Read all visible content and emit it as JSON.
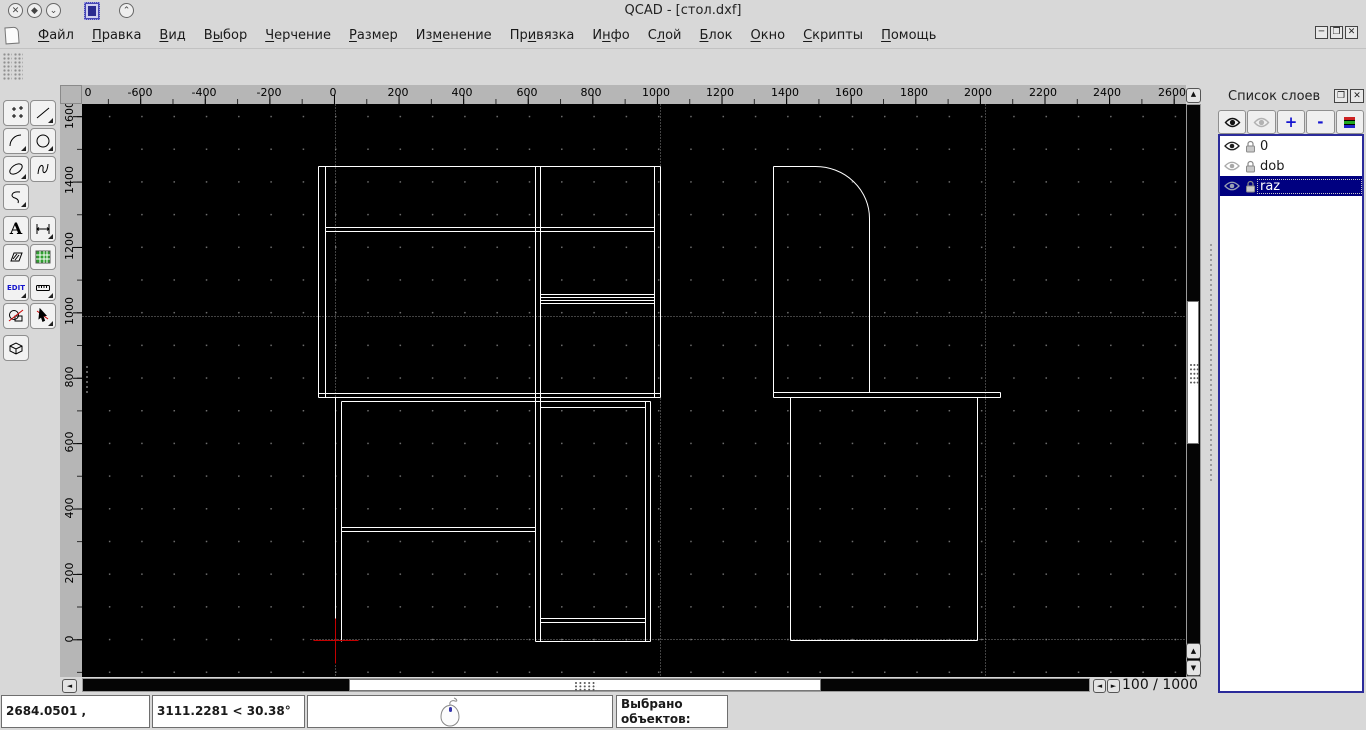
{
  "window": {
    "title": "QCAD - [стол.dxf]"
  },
  "titlebar": {
    "icons": [
      "close-circle-icon",
      "restore-circle-icon",
      "shade-circle-icon",
      "app-icon",
      "raise-circle-icon"
    ]
  },
  "menu": {
    "items": [
      {
        "label": "Файл",
        "accel": 0
      },
      {
        "label": "Правка",
        "accel": 0
      },
      {
        "label": "Вид",
        "accel": 0
      },
      {
        "label": "Выбор",
        "accel": 1
      },
      {
        "label": "Черчение",
        "accel": 0
      },
      {
        "label": "Размер",
        "accel": 0
      },
      {
        "label": "Изменение",
        "accel": 2
      },
      {
        "label": "Привязка",
        "accel": 2
      },
      {
        "label": "Инфо",
        "accel": 1
      },
      {
        "label": "Слой",
        "accel": 1
      },
      {
        "label": "Блок",
        "accel": 0
      },
      {
        "label": "Окно",
        "accel": 0
      },
      {
        "label": "Скрипты",
        "accel": 0
      },
      {
        "label": "Помощь",
        "accel": 0
      }
    ],
    "window_controls": [
      "minimize",
      "restore",
      "close"
    ]
  },
  "toolbar": {
    "tools": [
      "points",
      "line",
      "arc",
      "circle",
      "ellipse",
      "spline",
      "polyline",
      "text",
      "dimension",
      "hatch",
      "image",
      "edit",
      "measure",
      "explode",
      "select",
      "cube3d"
    ],
    "text_tool_label": "A",
    "edit_tool_label": "EDIT"
  },
  "rulers": {
    "horizontal": {
      "labels": [
        {
          "t": "0",
          "x": 6
        },
        {
          "t": "-600",
          "x": 58
        },
        {
          "t": "-400",
          "x": 122
        },
        {
          "t": "-200",
          "x": 187
        },
        {
          "t": "0",
          "x": 251
        },
        {
          "t": "200",
          "x": 316
        },
        {
          "t": "400",
          "x": 380
        },
        {
          "t": "600",
          "x": 445
        },
        {
          "t": "800",
          "x": 509
        },
        {
          "t": "1000",
          "x": 574
        },
        {
          "t": "1200",
          "x": 638
        },
        {
          "t": "1400",
          "x": 703
        },
        {
          "t": "1600",
          "x": 767
        },
        {
          "t": "1800",
          "x": 832
        },
        {
          "t": "2000",
          "x": 896
        },
        {
          "t": "2200",
          "x": 961
        },
        {
          "t": "2400",
          "x": 1025
        },
        {
          "t": "2600",
          "x": 1090
        }
      ]
    },
    "vertical": {
      "labels": [
        {
          "t": "1600",
          "y": 11
        },
        {
          "t": "1400",
          "y": 76
        },
        {
          "t": "1200",
          "y": 142
        },
        {
          "t": "1000",
          "y": 207
        },
        {
          "t": "800",
          "y": 273
        },
        {
          "t": "600",
          "y": 338
        },
        {
          "t": "400",
          "y": 404
        },
        {
          "t": "200",
          "y": 469
        },
        {
          "t": "0",
          "y": 535
        }
      ]
    }
  },
  "canvas": {
    "bg": "#000000",
    "line_color": "#ffffff",
    "construction_color": "#848484",
    "crosshair_color": "#c40000",
    "grid_dot_color": "#6e6e6e",
    "construction_lines": [
      [
        253,
        0,
        253,
        573
      ],
      [
        578,
        0,
        578,
        573
      ],
      [
        903,
        0,
        903,
        573
      ],
      [
        0,
        212,
        1104,
        212
      ],
      [
        228,
        535,
        1104,
        535
      ]
    ],
    "lines": [
      [
        236,
        62,
        578,
        62
      ],
      [
        236,
        62,
        236,
        293
      ],
      [
        243,
        62,
        243,
        293
      ],
      [
        572,
        62,
        572,
        293
      ],
      [
        578,
        62,
        578,
        293
      ],
      [
        236,
        289,
        578,
        289
      ],
      [
        236,
        293,
        578,
        293
      ],
      [
        243,
        123,
        572,
        123
      ],
      [
        243,
        127,
        572,
        127
      ],
      [
        453,
        62,
        453,
        537
      ],
      [
        458,
        62,
        458,
        537
      ],
      [
        458,
        190,
        572,
        190
      ],
      [
        458,
        193,
        572,
        193
      ],
      [
        458,
        196,
        572,
        196
      ],
      [
        458,
        199,
        572,
        199
      ],
      [
        259,
        297,
        568,
        297
      ],
      [
        253,
        293,
        253,
        537
      ],
      [
        259,
        297,
        259,
        537
      ],
      [
        259,
        423,
        453,
        423
      ],
      [
        259,
        427,
        453,
        427
      ],
      [
        563,
        297,
        563,
        537
      ],
      [
        568,
        297,
        568,
        537
      ],
      [
        458,
        303,
        563,
        303
      ],
      [
        458,
        514,
        563,
        514
      ],
      [
        458,
        518,
        563,
        518
      ],
      [
        453,
        537,
        568,
        537
      ],
      [
        691,
        62,
        691,
        288
      ],
      [
        691,
        62,
        733,
        62
      ],
      [
        787,
        114,
        787,
        288
      ],
      [
        691,
        288,
        918,
        288
      ],
      [
        691,
        293,
        918,
        293
      ],
      [
        691,
        288,
        691,
        293
      ],
      [
        918,
        288,
        918,
        293
      ],
      [
        708,
        293,
        708,
        536
      ],
      [
        895,
        293,
        895,
        536
      ],
      [
        708,
        536,
        895,
        536
      ]
    ],
    "arcs": [
      {
        "d": "M733,62 A54,52 0 0 1 787,114"
      }
    ],
    "crosshair": {
      "h": [
        231,
        536,
        276,
        536
      ],
      "v": [
        253,
        514,
        253,
        559
      ]
    }
  },
  "navigation": {
    "grid_indicator": "100 / 1000"
  },
  "layer_panel": {
    "title": "Список слоев",
    "toolbar": {
      "show_icon": "eye-open-icon",
      "hide_icon": "eye-closed-icon",
      "add_label": "+",
      "remove_label": "-",
      "attributes_icon": "layer-attributes-icon"
    },
    "layers": [
      {
        "name": "0",
        "eye": "dark",
        "locked": true,
        "selected": false
      },
      {
        "name": "dob",
        "eye": "gray",
        "locked": true,
        "selected": false
      },
      {
        "name": "raz",
        "eye": "slate",
        "locked": true,
        "selected": true
      }
    ]
  },
  "statusbar": {
    "abs_coords": "2684.0501 , 1573.4087",
    "polar_coords": "3111.2281 < 30.38°",
    "selected_label": "Выбрано объектов:",
    "selected_count": "0"
  }
}
